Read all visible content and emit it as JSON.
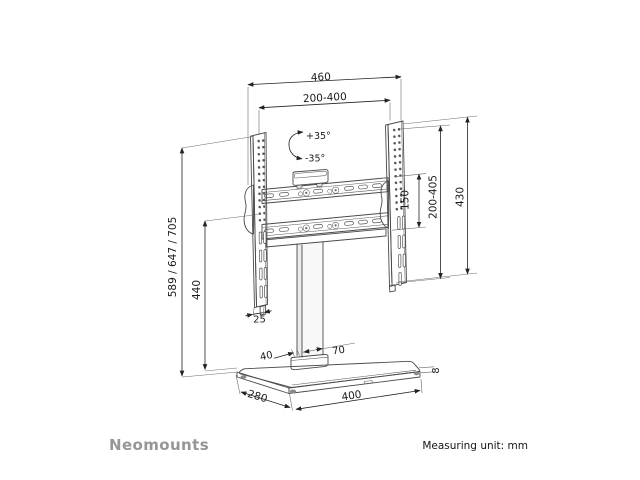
{
  "footer": {
    "brand": "Neomounts",
    "unit_note": "Measuring unit: mm"
  },
  "dimensions": {
    "outer_width": "460",
    "vesa_width_range": "200-400",
    "swivel_positive": "+35°",
    "swivel_negative": "-35°",
    "bracket_height": "430",
    "vesa_height_range": "200-405",
    "rail_spacing": "150",
    "height_options": "589 / 647 / 705",
    "column_height": "440",
    "bracket_thickness": "25",
    "column_depth": "40",
    "column_width": "70",
    "base_thickness": "8",
    "base_depth": "280",
    "base_width": "400"
  },
  "colors": {
    "object_line": "#4a4a4a",
    "dimension_line": "#222222",
    "brand_gray": "#969696",
    "background": "#ffffff"
  }
}
